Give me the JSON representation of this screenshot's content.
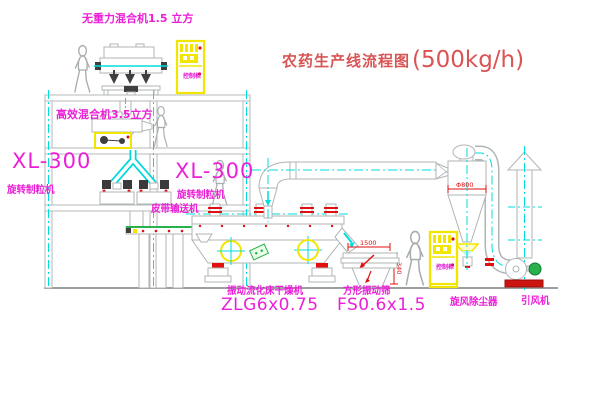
{
  "title": {
    "text_cn": "农药生产线流程图",
    "capacity": "(500kg/h)"
  },
  "equipment_labels": {
    "gravity_mixer": "无重力混合机1.5 立方",
    "high_efficiency_mixer": "高效混合机3.5立方",
    "granulator_left": {
      "model": "XL-300",
      "name": "旋转制粒机"
    },
    "granulator_center": {
      "model": "XL-300",
      "name": "旋转制粒机"
    },
    "belt_conveyor": "皮带输送机",
    "fluid_bed_dryer": {
      "name": "振动流化床干燥机",
      "model": "ZLG6x0.75"
    },
    "vibrating_screen": {
      "name": "方形振动筛",
      "model": "FS0.6x1.5"
    },
    "cyclone": "旋风除尘器",
    "fan": "引风机"
  },
  "control_cabinet": {
    "label": "控制柜"
  },
  "dimensions": {
    "screen_length": "1500",
    "screen_height": "340",
    "cyclone_dia": "Φ800"
  },
  "colors": {
    "label_magenta": "#ec1fd8",
    "title_red": "#d95454",
    "line_gray": "#b5baba",
    "centerline_cyan": "#00dede",
    "accent_yellow": "#f2e600",
    "accent_red": "#e01010",
    "accent_green": "#29b14d"
  }
}
